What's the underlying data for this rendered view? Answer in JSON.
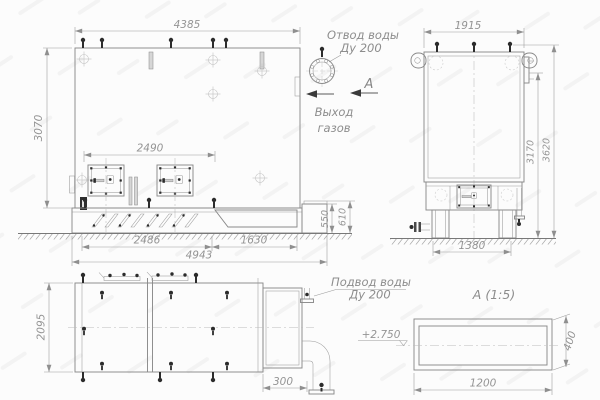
{
  "front_view": {
    "dim_width_top": "4385",
    "dim_height_left": "3070",
    "dim_doors": "2490",
    "dim_base_left": "2486",
    "dim_base_right": "1630",
    "dim_base_total": "4943",
    "dim_base_height": "550",
    "dim_frame_height": "610",
    "water_outlet_label_1": "Отвод воды",
    "water_outlet_label_2": "Ду 200",
    "gas_exit_label_1": "Выход",
    "gas_exit_label_2": "газов",
    "section_letter": "А"
  },
  "side_view": {
    "dim_width_top": "1915",
    "dim_height_flange": "3170",
    "dim_height_total": "3620",
    "dim_base_width": "1380"
  },
  "plan_view": {
    "dim_depth": "2095",
    "dim_pipe_offset": "300",
    "water_inlet_label_1": "Подвод воды",
    "water_inlet_label_2": "Ду 200"
  },
  "detail_view": {
    "title": "А  (1:5)",
    "dim_width": "1200",
    "dim_height": "400",
    "level_mark": "+2.750"
  },
  "colors": {
    "line": "#8a8a8a",
    "dark": "#2c2c2c",
    "dim_text": "#969696",
    "background": "#fcfcfc"
  }
}
